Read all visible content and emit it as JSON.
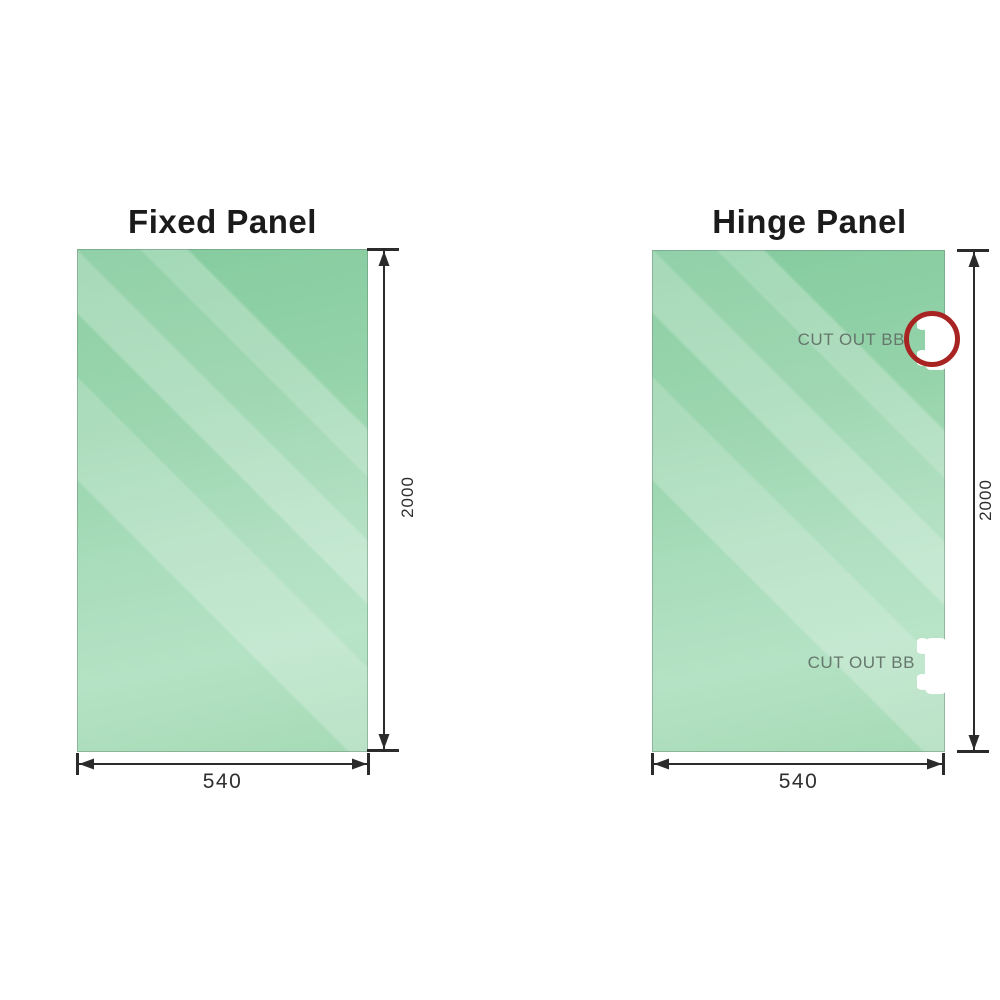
{
  "colors": {
    "glass_green_dark": "#84cb9e",
    "glass_green_light": "#c2e8d0",
    "dimension_line": "#2b2b2b",
    "cutout_label_gray": "#66776d",
    "highlight_ring_red": "#a82422",
    "title_black": "#1b1b1b",
    "background": "#ffffff"
  },
  "fixed_panel": {
    "title": "Fixed Panel",
    "width_label": "540",
    "height_label": "2000"
  },
  "hinge_panel": {
    "title": "Hinge Panel",
    "width_label": "540",
    "height_label": "2000",
    "cutouts": [
      {
        "label": "CUT OUT BB",
        "position": "top",
        "highlighted": true
      },
      {
        "label": "CUT OUT BB",
        "position": "bottom",
        "highlighted": false
      }
    ]
  }
}
